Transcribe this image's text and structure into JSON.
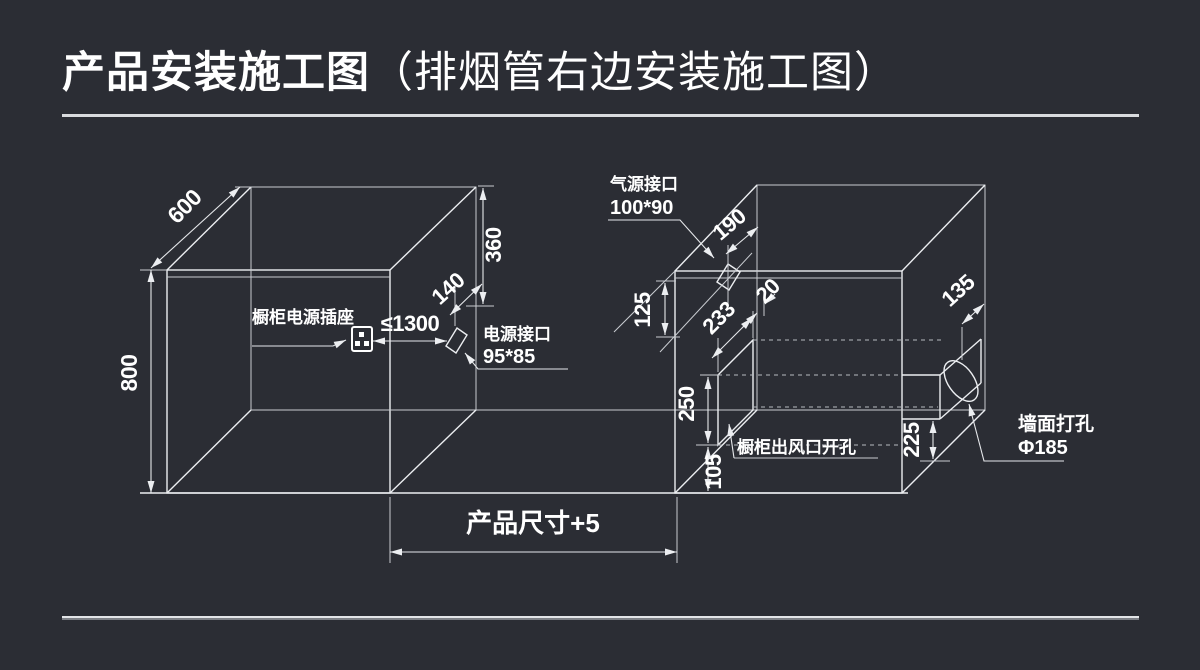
{
  "title": {
    "main": "产品安装施工图",
    "sub": "（排烟管右边安装施工图）"
  },
  "left_cabinet": {
    "depth": "600",
    "height": "800",
    "socket_label": "橱柜电源插座",
    "socket_distance": "≤1300",
    "power_port_title": "电源接口",
    "power_port_size": "95*85",
    "power_port_depth": "140",
    "power_port_drop": "360"
  },
  "right_cabinet": {
    "gas_port_title": "气源接口",
    "gas_port_size": "100*90",
    "gas_port_offset": "190",
    "top_drop": "125",
    "duct_depth": "233",
    "wall_gap": "20",
    "outlet_height": "250",
    "outlet_floor_gap": "105",
    "outlet_label": "橱柜出风口开孔",
    "hole_depth": "135",
    "hole_height": "225",
    "wall_hole_title": "墙面打孔",
    "wall_hole_size": "Φ185"
  },
  "bottom_dim": {
    "label": "产品尺寸+5"
  },
  "colors": {
    "background": "#2b2d34",
    "line": "#eceef1",
    "text": "#ffffff"
  }
}
